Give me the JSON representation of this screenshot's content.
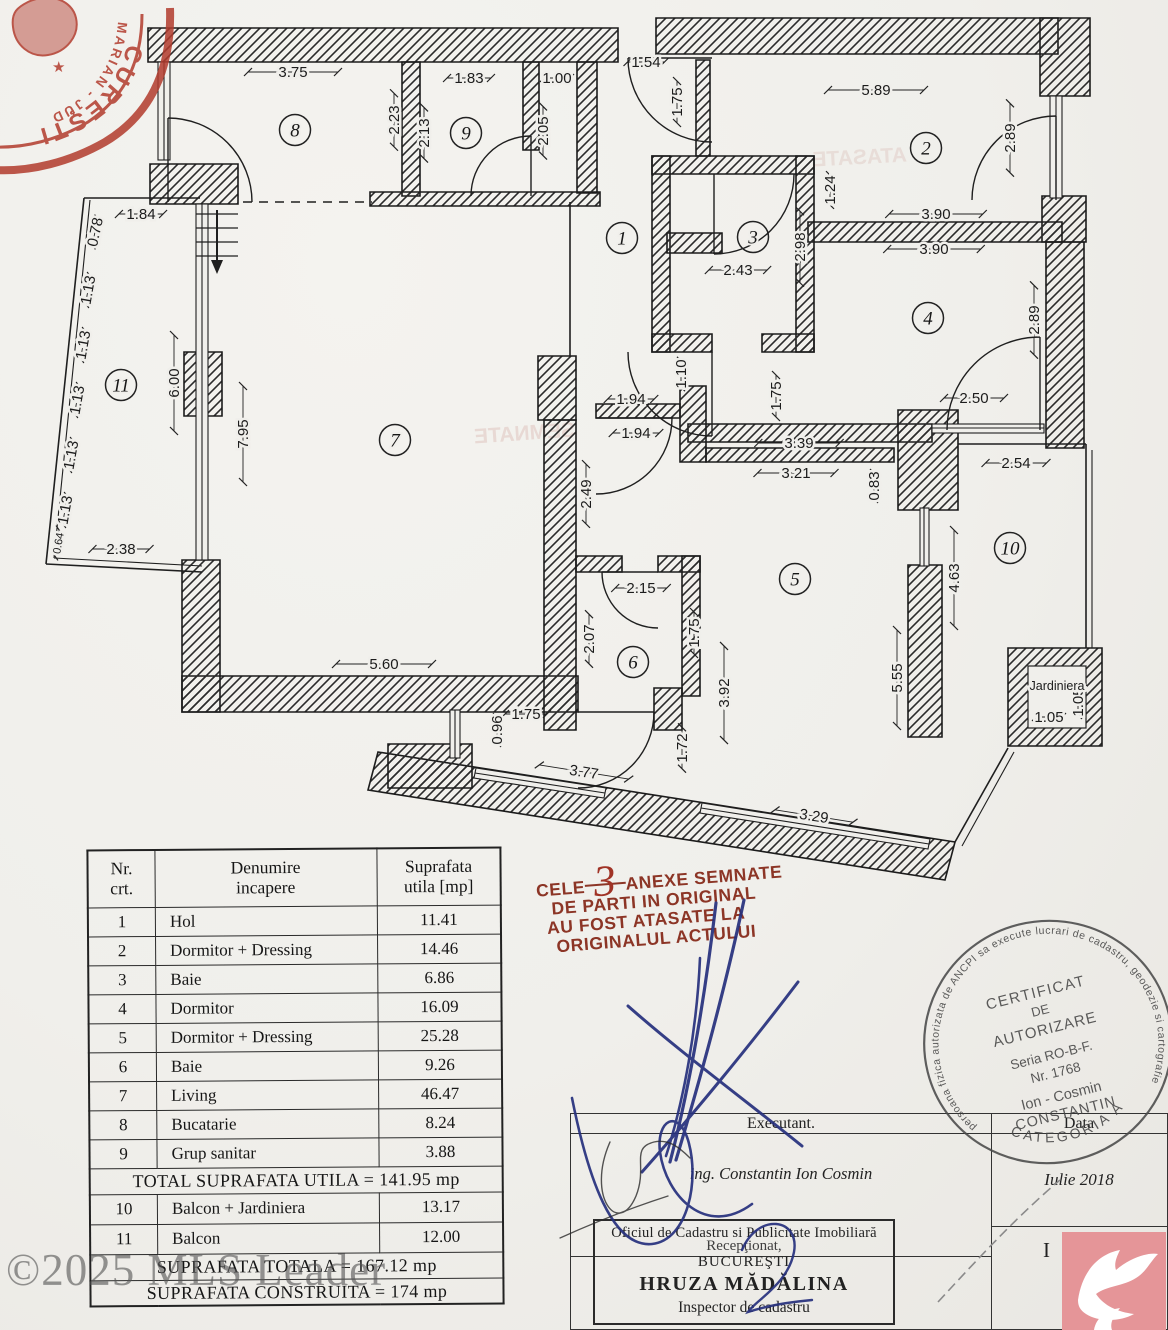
{
  "watermark": "©2025 MLS Leader",
  "colors": {
    "stamp_red": "#b23b2d",
    "note_red": "#8c3526",
    "logo_pink": "#e59598",
    "ink_blue": "#26307d"
  },
  "notary_stamp": {
    "arc_text_small": "MARIAN - JUD",
    "arc_text_large": "CUREŞTI",
    "star": "★"
  },
  "red_note": {
    "prefix": "CELE",
    "number": "3",
    "line1_rest": "ANEXE SEMNATE",
    "line2": "DE PARTI IN ORIGINAL",
    "line3": "AU FOST ATASATE LA",
    "line4": "ORIGINALUL ACTULUI"
  },
  "cert_stamp": {
    "ring_text": "persoana fizica autorizata de ANCPI sa execute lucrari de cadastru, geodezie si cartografie",
    "bottom_arc": "CATEGORIA A",
    "l1": "CERTIFICAT",
    "l2": "DE",
    "l3": "AUTORIZARE",
    "l4": "Seria RO-B-F.",
    "l5": "Nr. 1768",
    "l6": "Ion - Cosmin",
    "l7": "CONSTANTIN"
  },
  "form": {
    "executant_label": "Executant.",
    "executant_name": "ing. Constantin Ion Cosmin",
    "data_label": "Data",
    "data_value": "Iulie 2018",
    "office_line1": "Oficiul de Cadastru si Publicitate Imobiliară",
    "receptionat": "Recepţionat,",
    "office_line2": "BUCUREŞTI",
    "inspector_name": "HRUZA MĂDĂLINA",
    "inspector_title": "Inspector de cadastru",
    "partial": "I"
  },
  "table": {
    "headers": [
      "Nr.\ncrt.",
      "Denumire\nincapere",
      "Suprafata\nutila [mp]"
    ],
    "rows": [
      [
        "1",
        "Hol",
        "11.41"
      ],
      [
        "2",
        "Dormitor + Dressing",
        "14.46"
      ],
      [
        "3",
        "Baie",
        "6.86"
      ],
      [
        "4",
        "Dormitor",
        "16.09"
      ],
      [
        "5",
        "Dormitor + Dressing",
        "25.28"
      ],
      [
        "6",
        "Baie",
        "9.26"
      ],
      [
        "7",
        "Living",
        "46.47"
      ],
      [
        "8",
        "Bucatarie",
        "8.24"
      ],
      [
        "9",
        "Grup sanitar",
        "3.88"
      ]
    ],
    "total_utila": "TOTAL SUPRAFATA UTILA = 141.95 mp",
    "rows2": [
      [
        "10",
        "Balcon + Jardiniera",
        "13.17"
      ],
      [
        "11",
        "Balcon",
        "12.00"
      ]
    ],
    "total_totala": "SUPRAFATA TOTALA = 167.12 mp",
    "total_construita": "SUPRAFATA CONSTRUITA = 174 mp"
  },
  "floorplan": {
    "jardiniera_label": "Jardiniera",
    "rooms": [
      {
        "n": "1",
        "x": 622,
        "y": 238
      },
      {
        "n": "2",
        "x": 926,
        "y": 148
      },
      {
        "n": "3",
        "x": 753,
        "y": 237
      },
      {
        "n": "4",
        "x": 928,
        "y": 318
      },
      {
        "n": "5",
        "x": 795,
        "y": 579
      },
      {
        "n": "6",
        "x": 633,
        "y": 662
      },
      {
        "n": "7",
        "x": 395,
        "y": 440
      },
      {
        "n": "8",
        "x": 295,
        "y": 130
      },
      {
        "n": "9",
        "x": 466,
        "y": 133
      },
      {
        "n": "10",
        "x": 1010,
        "y": 548
      },
      {
        "n": "11",
        "x": 121,
        "y": 385
      }
    ],
    "dims": [
      {
        "v": "3.75",
        "x": 293,
        "y": 72
      },
      {
        "v": "1.83",
        "x": 469,
        "y": 78
      },
      {
        "v": "1.00",
        "x": 557,
        "y": 78
      },
      {
        "v": "1.54",
        "x": 646,
        "y": 62
      },
      {
        "v": "5.89",
        "x": 876,
        "y": 90
      },
      {
        "v": "2.23",
        "x": 394,
        "y": 120,
        "r": -90
      },
      {
        "v": "2.13",
        "x": 424,
        "y": 133,
        "r": -90
      },
      {
        "v": "2.05",
        "x": 543,
        "y": 131,
        "r": -90
      },
      {
        "v": "1.75",
        "x": 677,
        "y": 102,
        "r": -90
      },
      {
        "v": "2.89",
        "x": 1010,
        "y": 138,
        "r": -90
      },
      {
        "v": "1.24",
        "x": 830,
        "y": 190,
        "r": -90
      },
      {
        "v": "3.90",
        "x": 936,
        "y": 214
      },
      {
        "v": "3.90",
        "x": 934,
        "y": 249
      },
      {
        "v": "2.98",
        "x": 800,
        "y": 247,
        "r": -90
      },
      {
        "v": "2.43",
        "x": 738,
        "y": 270
      },
      {
        "v": "2.89",
        "x": 1034,
        "y": 320,
        "r": -90
      },
      {
        "v": "1.84",
        "x": 141,
        "y": 214
      },
      {
        "v": "0.78",
        "x": 95,
        "y": 232,
        "r": -78
      },
      {
        "v": "1.13",
        "x": 88,
        "y": 290,
        "r": -80
      },
      {
        "v": "1.13",
        "x": 83,
        "y": 345,
        "r": -80
      },
      {
        "v": "1.13",
        "x": 77,
        "y": 400,
        "r": -80
      },
      {
        "v": "1.13",
        "x": 71,
        "y": 455,
        "r": -80
      },
      {
        "v": "1.13",
        "x": 65,
        "y": 510,
        "r": -80
      },
      {
        "v": "0.64",
        "x": 57,
        "y": 543,
        "r": -80,
        "s": 11
      },
      {
        "v": "2.38",
        "x": 121,
        "y": 549
      },
      {
        "v": "6.00",
        "x": 174,
        "y": 383,
        "r": -90
      },
      {
        "v": "7.95",
        "x": 243,
        "y": 434,
        "r": -90
      },
      {
        "v": "1.94",
        "x": 631,
        "y": 399
      },
      {
        "v": "1.94",
        "x": 636,
        "y": 433
      },
      {
        "v": "1.10",
        "x": 681,
        "y": 374,
        "r": -90
      },
      {
        "v": "1.75",
        "x": 776,
        "y": 396,
        "r": -90
      },
      {
        "v": "3.39",
        "x": 799,
        "y": 443
      },
      {
        "v": "3.21",
        "x": 796,
        "y": 473
      },
      {
        "v": "0.83",
        "x": 874,
        "y": 486,
        "r": -90
      },
      {
        "v": "2.50",
        "x": 974,
        "y": 398
      },
      {
        "v": "2.54",
        "x": 1016,
        "y": 463
      },
      {
        "v": "2.49",
        "x": 586,
        "y": 494,
        "r": -90
      },
      {
        "v": "2.15",
        "x": 641,
        "y": 588
      },
      {
        "v": "2.07",
        "x": 589,
        "y": 639,
        "r": -90
      },
      {
        "v": "1.75",
        "x": 694,
        "y": 633,
        "r": -90
      },
      {
        "v": "3.92",
        "x": 724,
        "y": 693,
        "r": -90
      },
      {
        "v": "4.63",
        "x": 954,
        "y": 578,
        "r": -90
      },
      {
        "v": "5.55",
        "x": 897,
        "y": 678,
        "r": -90
      },
      {
        "v": "5.60",
        "x": 384,
        "y": 664
      },
      {
        "v": "1.75",
        "x": 526,
        "y": 714
      },
      {
        "v": "0.96",
        "x": 497,
        "y": 730,
        "r": -90
      },
      {
        "v": "3.77",
        "x": 584,
        "y": 772,
        "r": 9
      },
      {
        "v": "1.72",
        "x": 682,
        "y": 748,
        "r": -90
      },
      {
        "v": "3.29",
        "x": 814,
        "y": 816,
        "r": 9
      },
      {
        "v": "1.05",
        "x": 1049,
        "y": 717
      },
      {
        "v": "1.05",
        "x": 1078,
        "y": 702,
        "r": -90
      }
    ]
  }
}
